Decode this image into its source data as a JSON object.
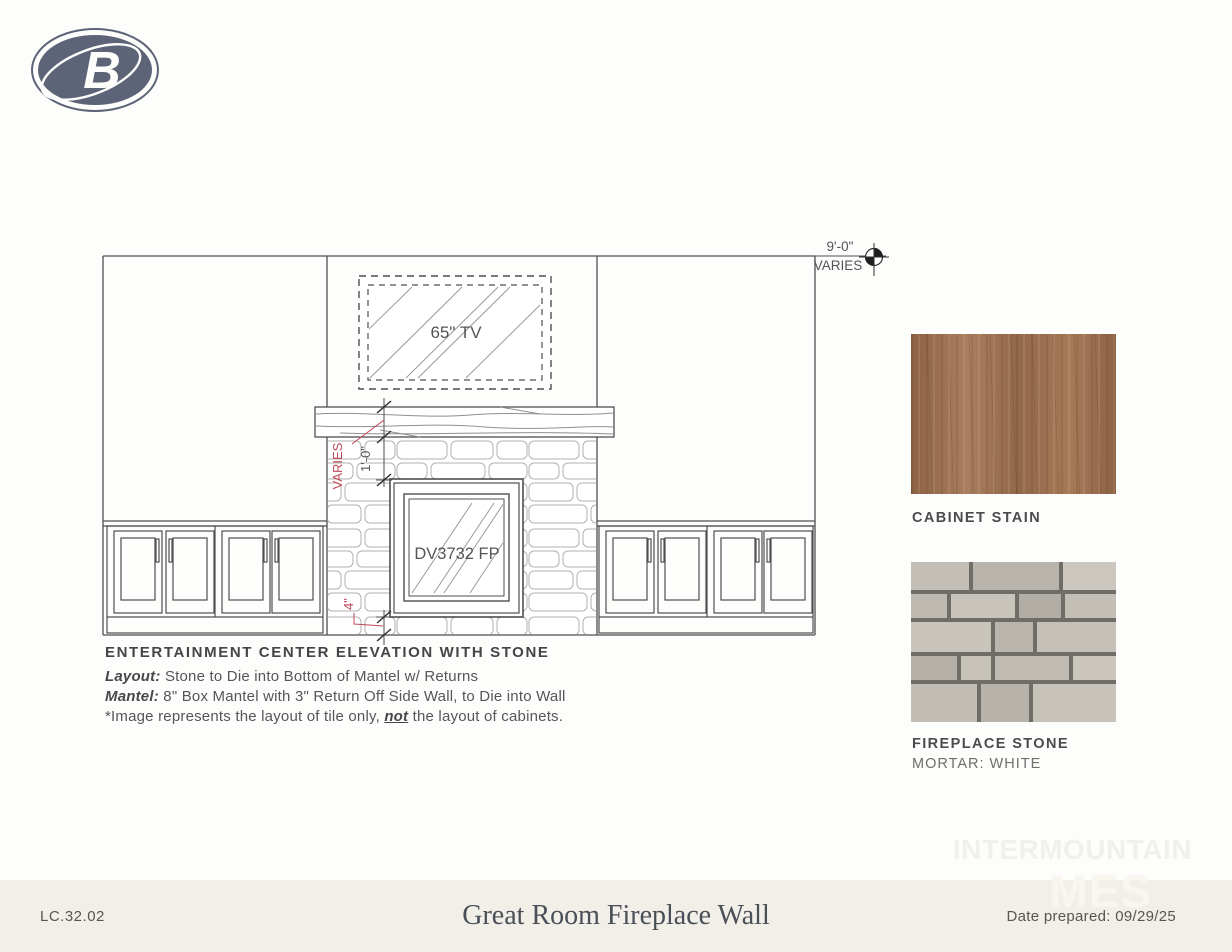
{
  "logo": {
    "letter": "B"
  },
  "drawing": {
    "dim_overall_l1": "9'-0\"",
    "dim_overall_l2": "VARIES",
    "tv_label": "65\" TV",
    "fireplace_label": "DV3732 FP",
    "dim_mantel_varies": "VARIES",
    "dim_mantel_to_fireplace": "1'-0\"",
    "dim_hearth": "4\""
  },
  "notes": {
    "title": "ENTERTAINMENT CENTER ELEVATION WITH STONE",
    "layout_label": "Layout:",
    "layout_text": " Stone to Die into Bottom of Mantel w/ Returns",
    "mantel_label": "Mantel:",
    "mantel_text": " 8\" Box Mantel with 3\" Return Off Side Wall, to Die into Wall",
    "footnote_pre": "*Image represents the layout of tile only, ",
    "footnote_emph": "not",
    "footnote_post": " the layout of cabinets."
  },
  "swatches": {
    "cabinet_label": "CABINET STAIN",
    "stone_label": "FIREPLACE STONE",
    "stone_sublabel": "MORTAR: WHITE"
  },
  "watermark": {
    "line1": "INTERMOUNTAIN",
    "line2": "MES"
  },
  "footer": {
    "code": "LC.32.02",
    "title": "Great Room Fireplace Wall",
    "date": "Date prepared: 09/29/25"
  },
  "colors": {
    "logo": "#5d6477",
    "drawing_line": "#4f4f51",
    "dimension_accent_red": "#bf4a57",
    "footer_bg": "#f2efe8",
    "wood_base": "#9c7356",
    "stone_joint": "#6e6d67"
  }
}
